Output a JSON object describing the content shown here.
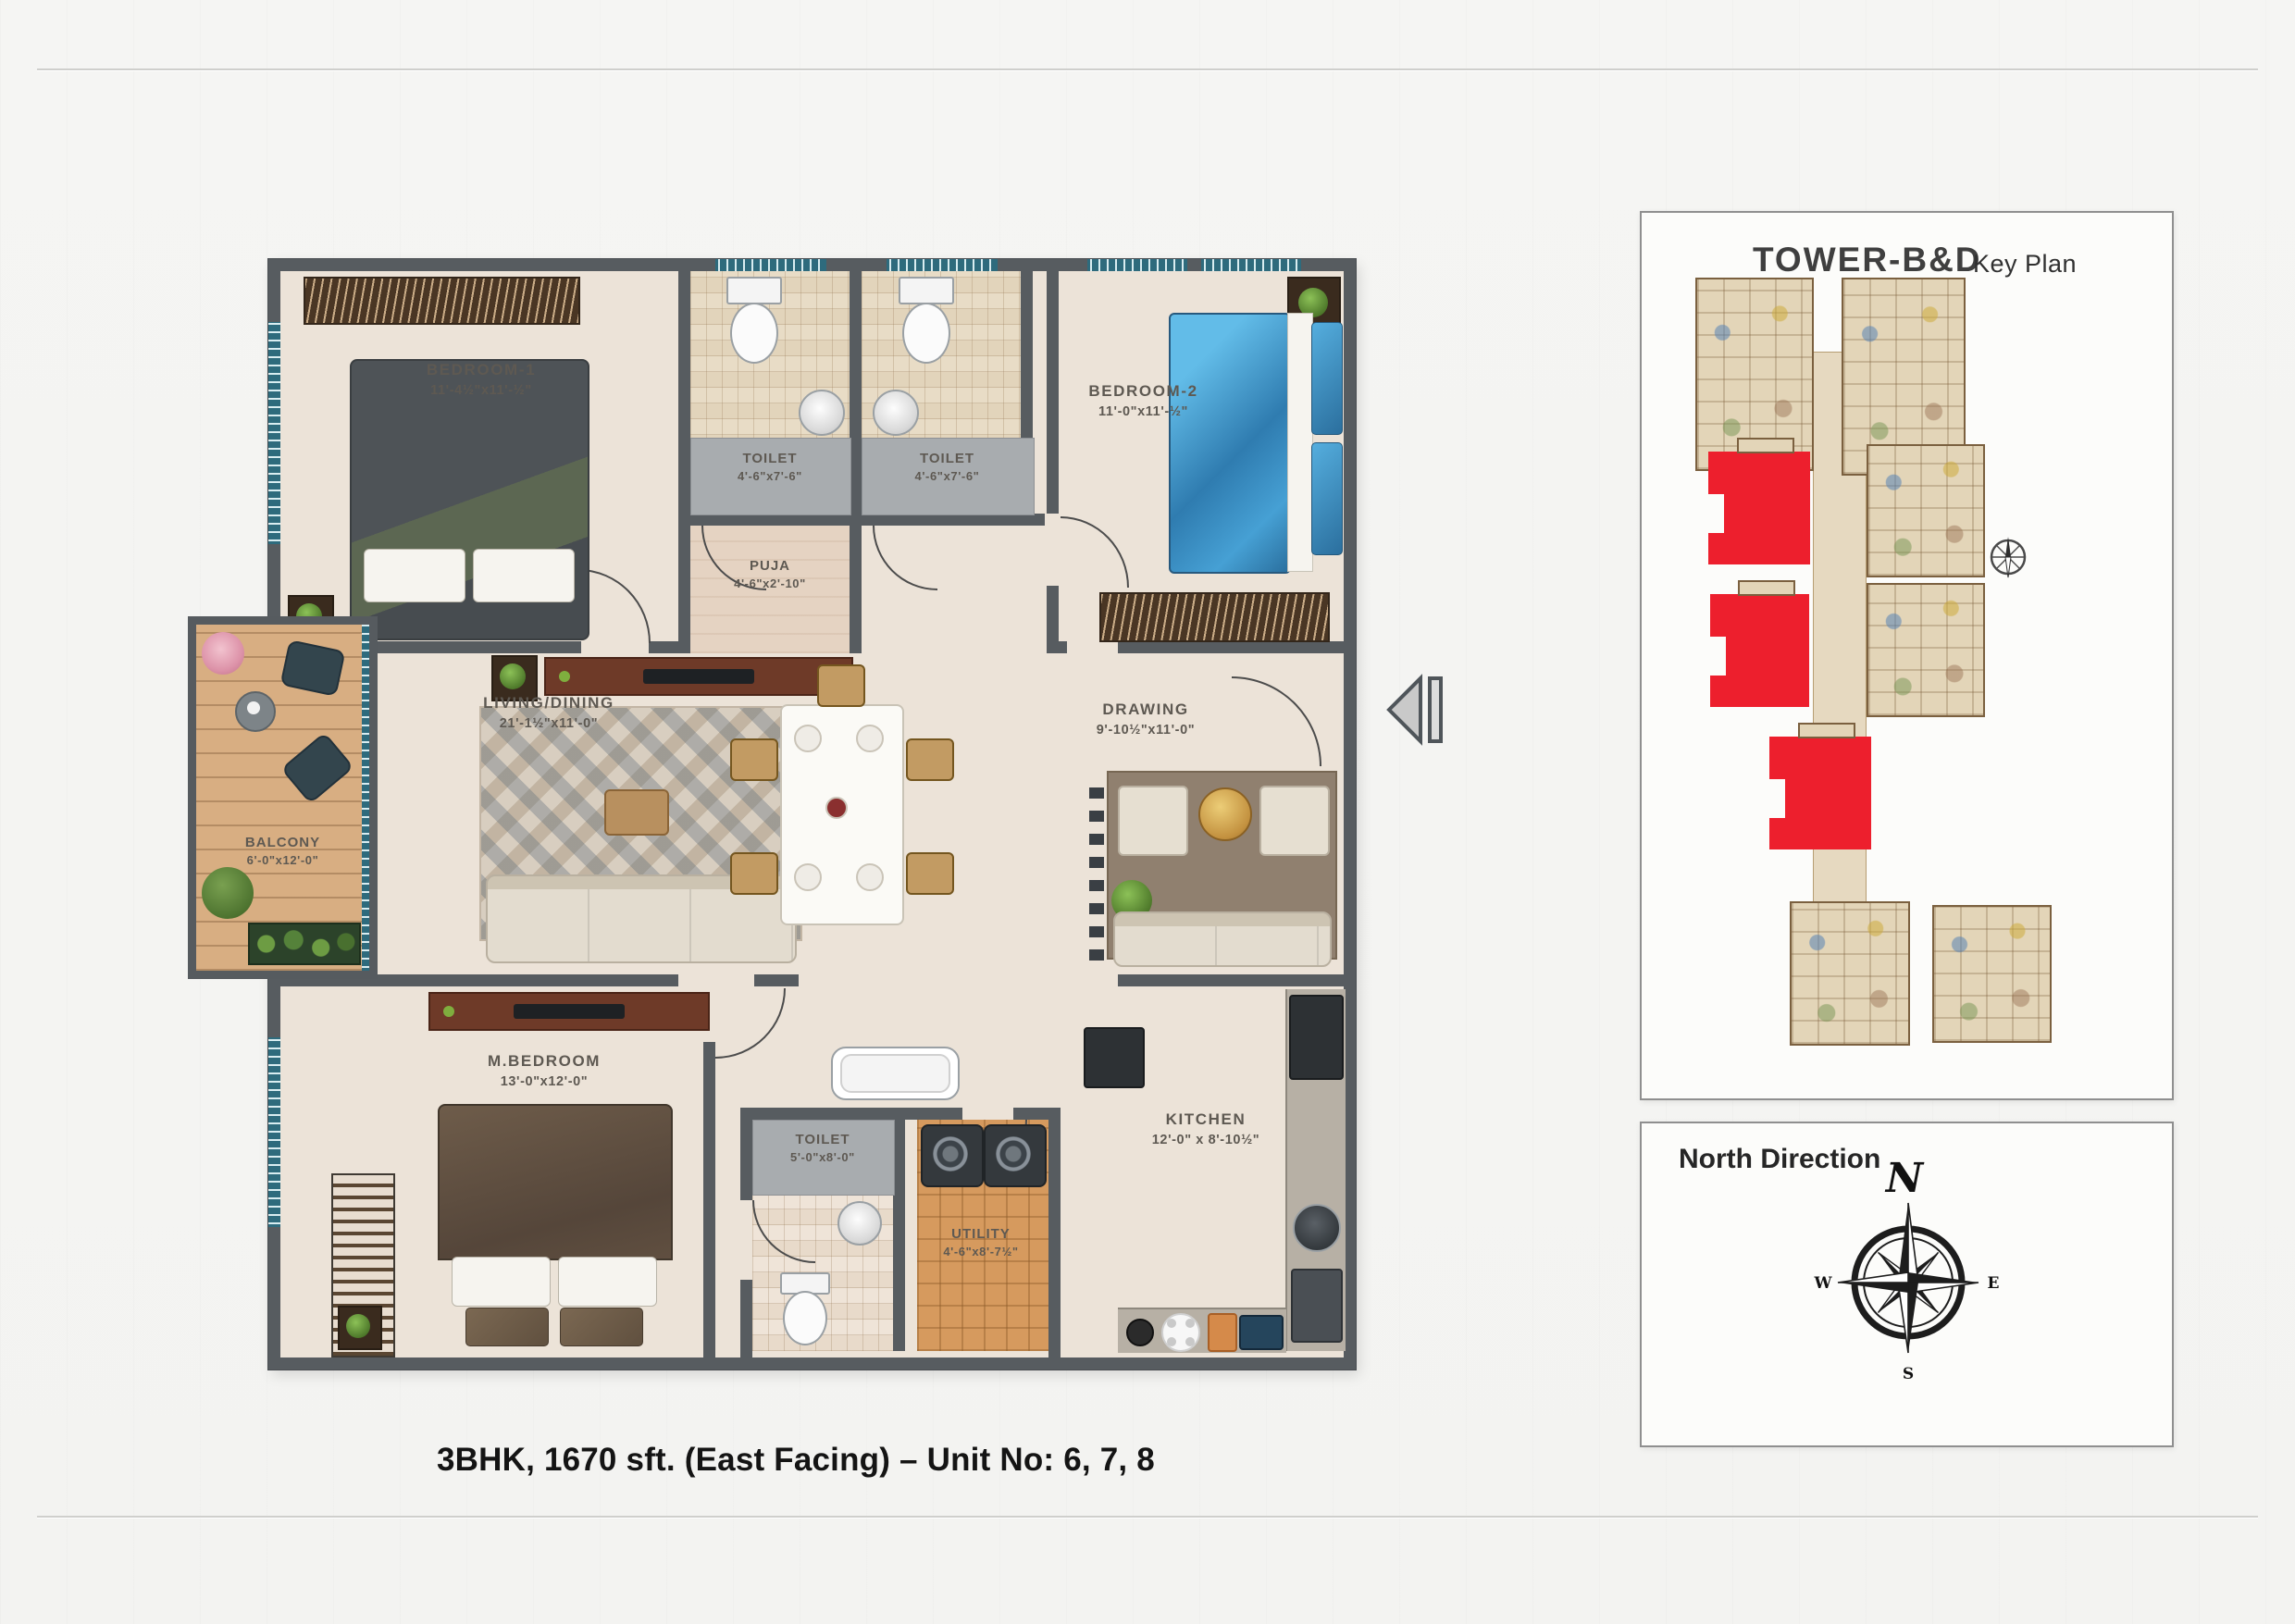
{
  "page": {
    "caption": "3BHK, 1670 sft. (East Facing) – Unit No: 6, 7, 8"
  },
  "floorplan": {
    "rooms": [
      {
        "name": "BEDROOM-1",
        "dim": "11'-4½\"x11'-½\""
      },
      {
        "name": "TOILET",
        "dim": "4'-6\"x7'-6\""
      },
      {
        "name": "TOILET",
        "dim": "4'-6\"x7'-6\""
      },
      {
        "name": "BEDROOM-2",
        "dim": "11'-0\"x11'-½\""
      },
      {
        "name": "PUJA",
        "dim": "4'-6\"x2'-10\""
      },
      {
        "name": "LIVING/DINING",
        "dim": "21'-1½\"x11'-0\""
      },
      {
        "name": "DRAWING",
        "dim": "9'-10½\"x11'-0\""
      },
      {
        "name": "BALCONY",
        "dim": "6'-0\"x12'-0\""
      },
      {
        "name": "M.BEDROOM",
        "dim": "13'-0\"x12'-0\""
      },
      {
        "name": "TOILET",
        "dim": "5'-0\"x8'-0\""
      },
      {
        "name": "UTILITY",
        "dim": "4'-6\"x8'-7½\""
      },
      {
        "name": "KITCHEN",
        "dim": "12'-0\" x 8'-10½\""
      }
    ]
  },
  "keyplan": {
    "title": "TOWER-B&D",
    "subtitle": "Key Plan"
  },
  "north": {
    "title": "North Direction",
    "n": "N",
    "e": "E",
    "s": "S",
    "w": "W"
  },
  "colors": {
    "highlight_red": "#ed1f2d",
    "wall_gray": "#575c60",
    "window_teal": "#2e6b7d"
  }
}
